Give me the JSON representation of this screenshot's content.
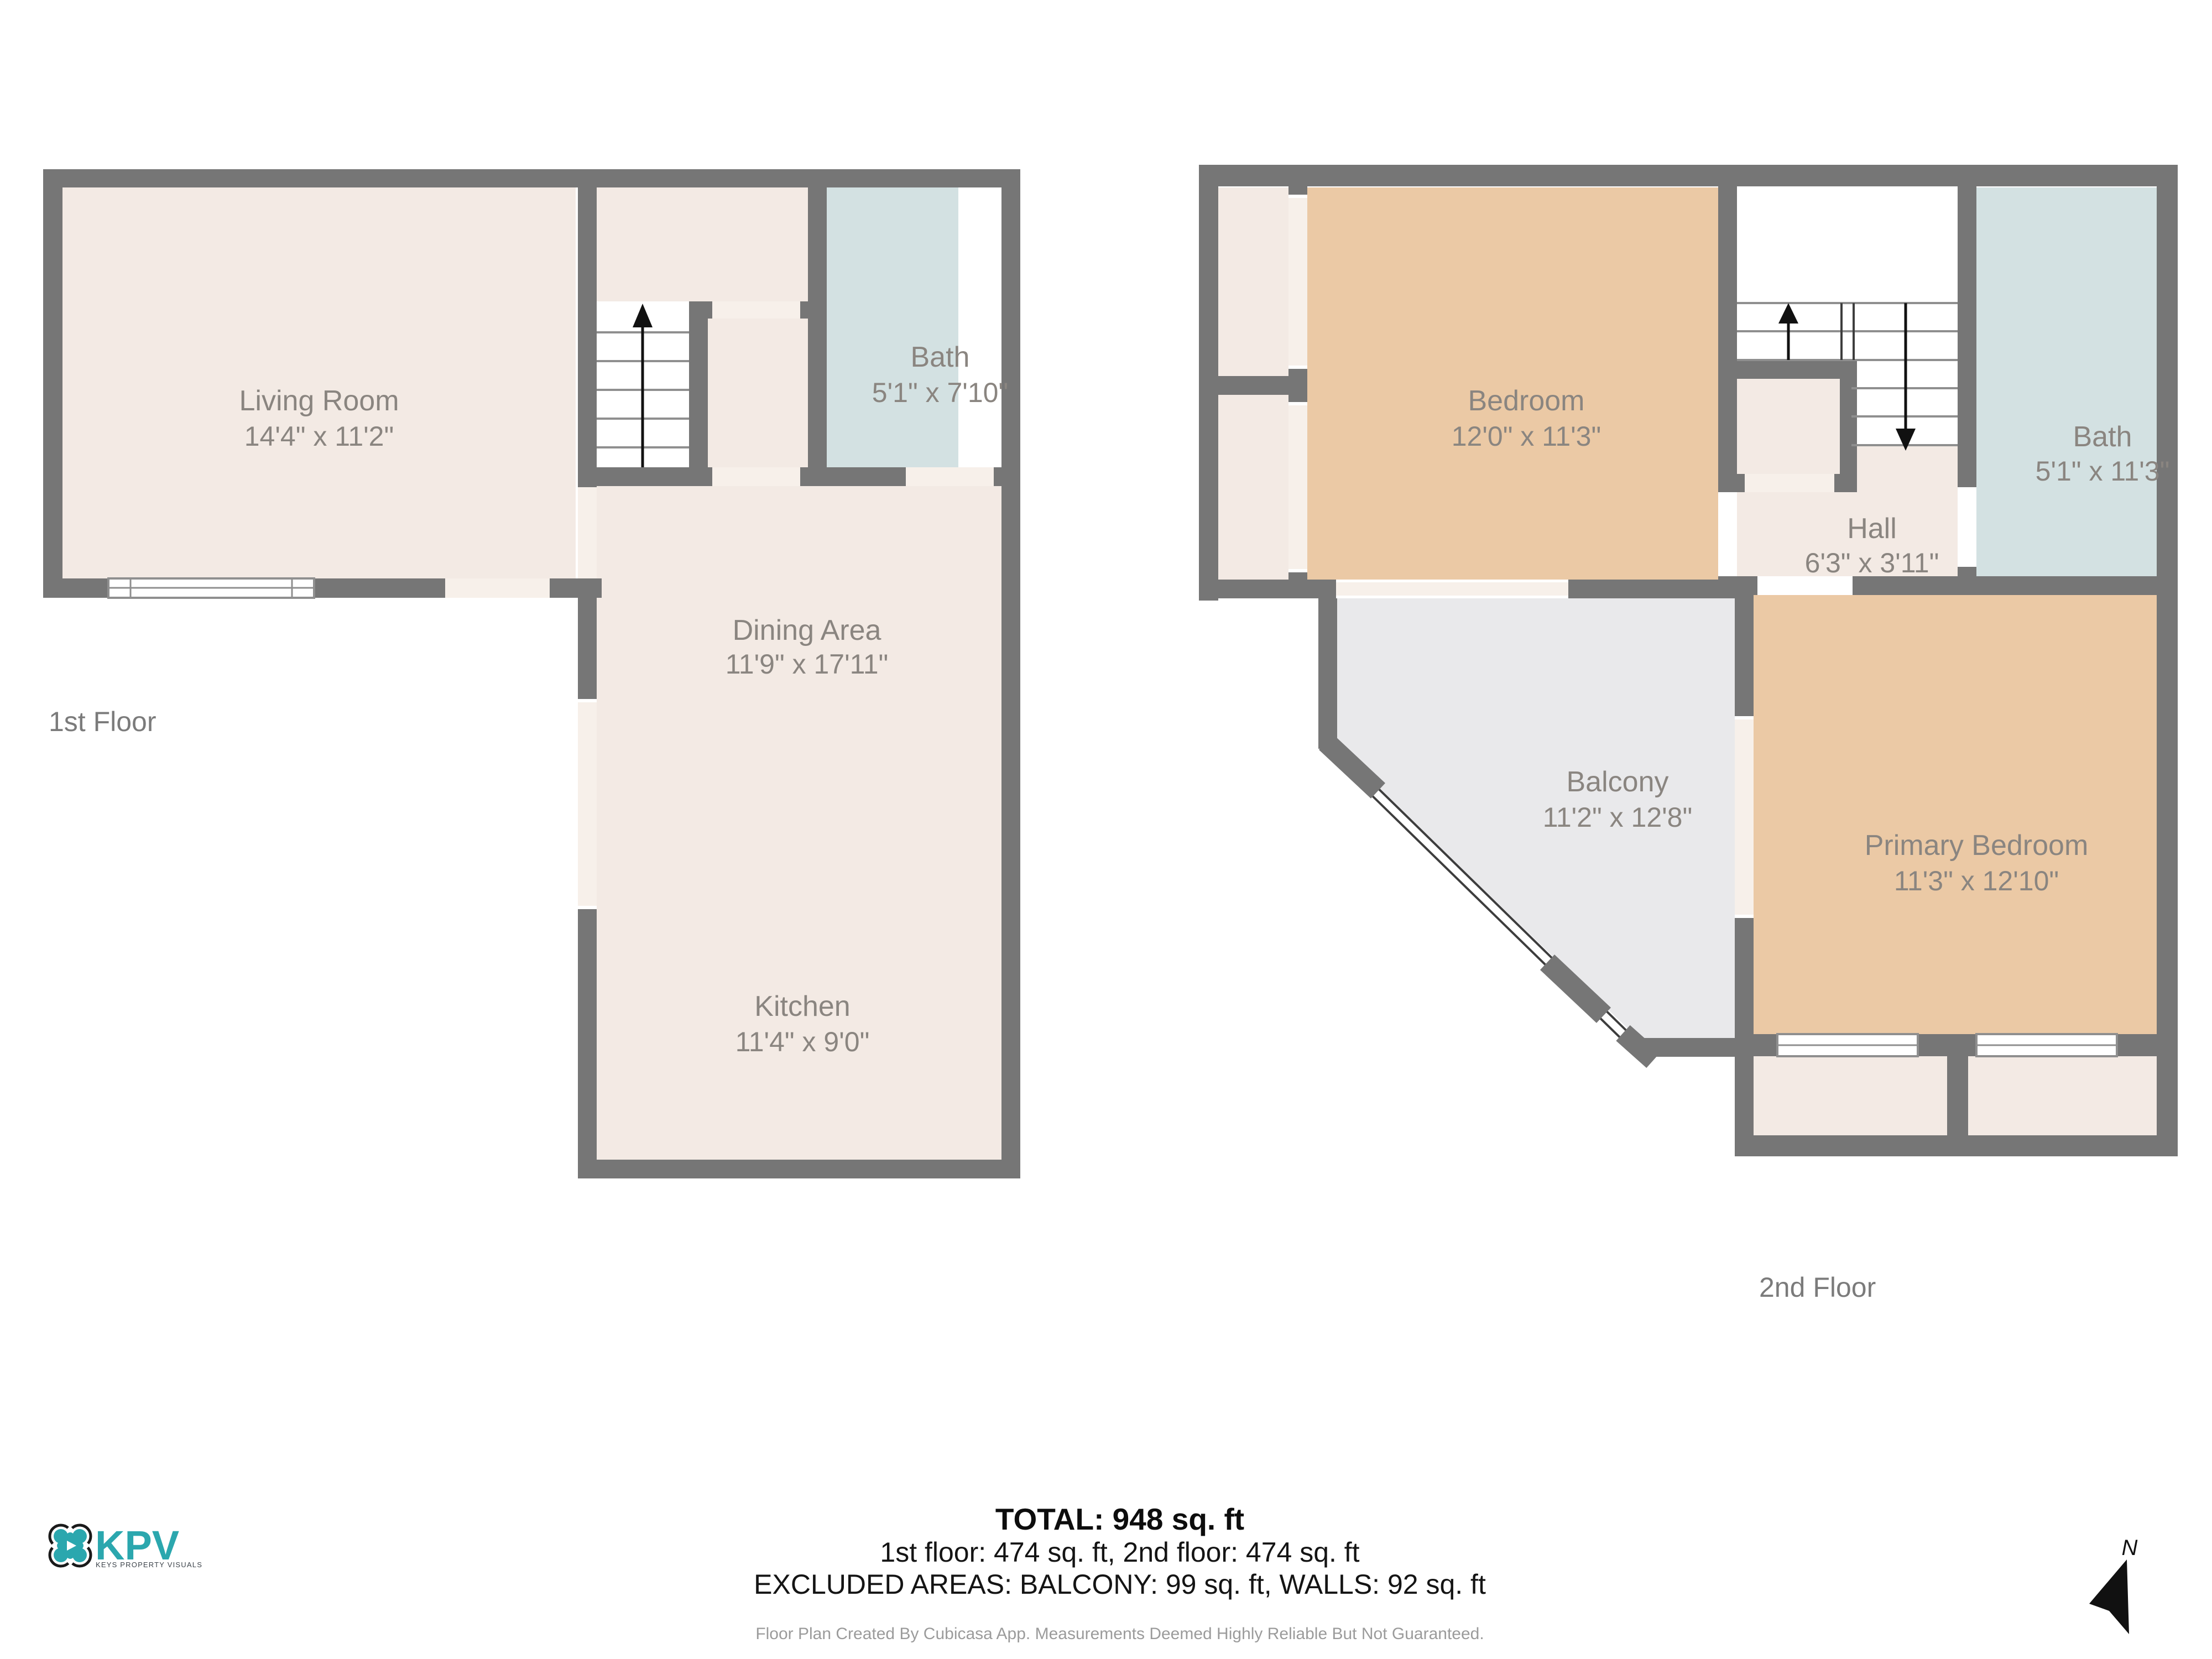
{
  "floor1": {
    "label": "1st Floor",
    "rooms": {
      "living": {
        "name": "Living Room",
        "dims": "14'4\" x 11'2\""
      },
      "bath": {
        "name": "Bath",
        "dims": "5'1\" x 7'10\""
      },
      "dining": {
        "name": "Dining Area",
        "dims": "11'9\" x 17'11\""
      },
      "kitchen": {
        "name": "Kitchen",
        "dims": "11'4\" x 9'0\""
      }
    }
  },
  "floor2": {
    "label": "2nd Floor",
    "rooms": {
      "bedroom": {
        "name": "Bedroom",
        "dims": "12'0\" x 11'3\""
      },
      "bath": {
        "name": "Bath",
        "dims": "5'1\" x 11'3\""
      },
      "hall": {
        "name": "Hall",
        "dims": "6'3\" x 3'11\""
      },
      "balcony": {
        "name": "Balcony",
        "dims": "11'2\" x 12'8\""
      },
      "primary": {
        "name": "Primary Bedroom",
        "dims": "11'3\" x 12'10\""
      }
    }
  },
  "footer": {
    "total": "TOTAL: 948 sq. ft",
    "floors": "1st floor: 474 sq. ft, 2nd floor: 474 sq. ft",
    "excluded": "EXCLUDED AREAS: BALCONY: 99 sq. ft, WALLS: 92 sq. ft",
    "disclaimer": "Floor Plan Created By Cubicasa App. Measurements Deemed Highly Reliable But Not Guaranteed."
  },
  "logo": {
    "brand": "KPV",
    "tagline": "KEYS PROPERTY VISUALS"
  },
  "compass": {
    "north_label": "N"
  },
  "colors": {
    "wall": "#767676",
    "room_fill": "#f3eae4",
    "door_gap_fill": "#f7f0ea",
    "bedroom_fill": "#ebc9a5",
    "bath_fill": "#d3e1e2",
    "balcony_fill": "#e9e9eb",
    "label_text": "#8a8580",
    "brand_teal": "#2ba7ae"
  }
}
